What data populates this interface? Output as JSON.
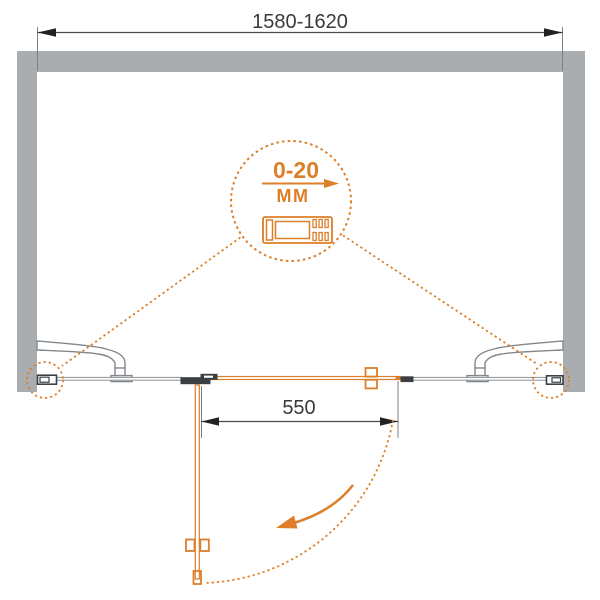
{
  "diagram": {
    "type": "shower-door-installation-plan",
    "colors": {
      "accent_orange": "#dd7e28",
      "wall_gray": "#a9adb0",
      "hardware_dark": "#3b3f43",
      "glass_gray": "#8a8f93",
      "dimension_text": "#3a3a3a"
    },
    "dimensions": {
      "overall_width_label": "1580-1620",
      "door_width_label": "550"
    },
    "adjustment_callout": {
      "range_label": "0-20",
      "unit_label": "ММ"
    }
  }
}
